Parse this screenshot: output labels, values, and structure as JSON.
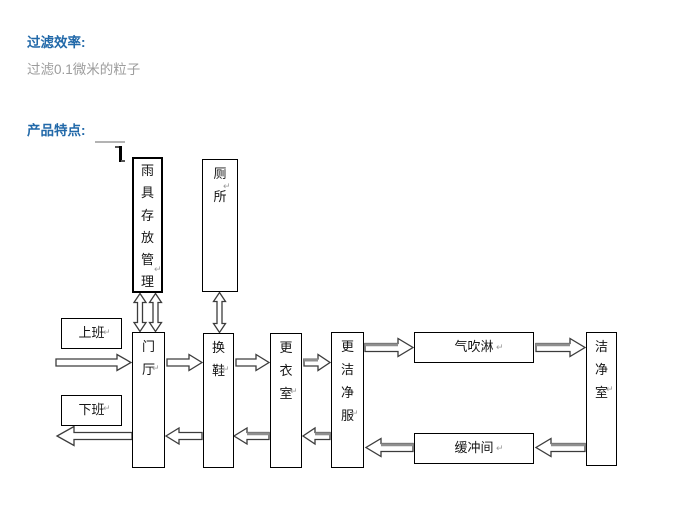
{
  "headings": {
    "filter_efficiency": "过滤效率:",
    "product_features": "产品特点:"
  },
  "texts": {
    "filter_description": "过滤0.1微米的粒子"
  },
  "colors": {
    "heading_blue": "#2269a9",
    "body_gray": "#9c9c9c",
    "box_border": "#000000",
    "arrow_outline": "#3c3c3c",
    "arrow_shadow": "#8f8f8f"
  },
  "diagram": {
    "return_mark": "↵",
    "boxes": [
      {
        "id": "rain-gear-storage",
        "label": "雨具存放管理"
      },
      {
        "id": "toilet",
        "label": "厕所"
      },
      {
        "id": "work-start",
        "label": "上班"
      },
      {
        "id": "work-end",
        "label": "下班"
      },
      {
        "id": "hall",
        "label": "门厅"
      },
      {
        "id": "change-shoes",
        "label": "换鞋"
      },
      {
        "id": "changing-room",
        "label": "更衣室"
      },
      {
        "id": "clean-garment",
        "label": "更洁净服"
      },
      {
        "id": "air-shower",
        "label": "气吹淋"
      },
      {
        "id": "buffer-room",
        "label": "缓冲间"
      },
      {
        "id": "clean-room",
        "label": "洁净室"
      }
    ]
  }
}
